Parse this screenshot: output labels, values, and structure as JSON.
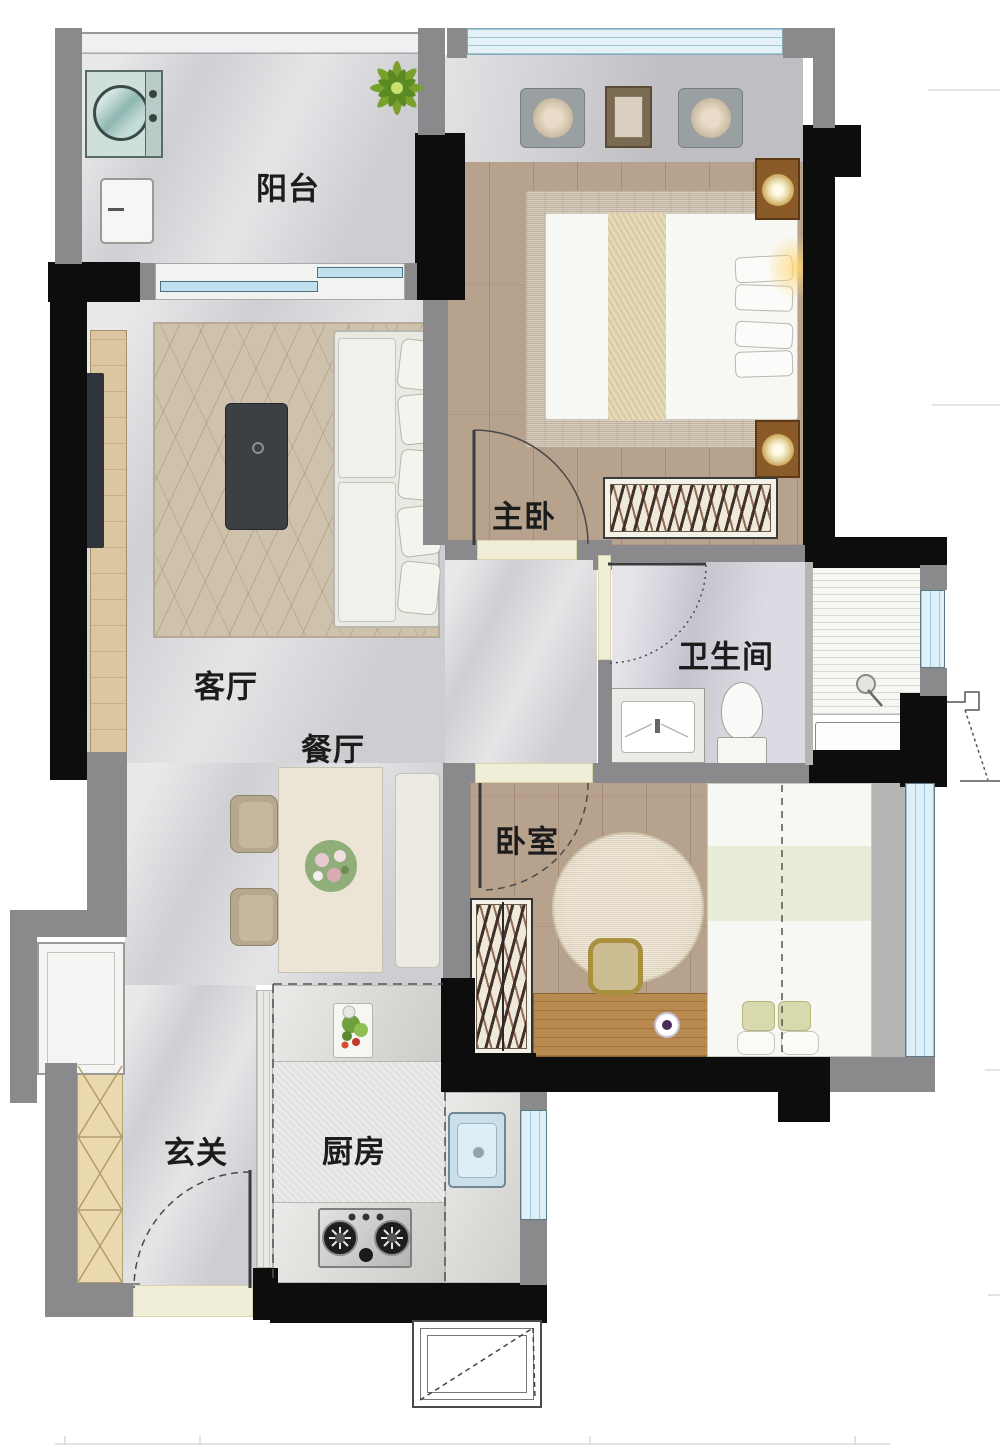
{
  "rooms": {
    "balcony": {
      "label": "阳台"
    },
    "master_bedroom": {
      "label": "主卧"
    },
    "living_room": {
      "label": "客厅"
    },
    "dining_room": {
      "label": "餐厅"
    },
    "bathroom": {
      "label": "卫生间"
    },
    "bedroom": {
      "label": "卧室"
    },
    "kitchen": {
      "label": "厨房"
    },
    "entry": {
      "label": "玄关"
    }
  },
  "colors": {
    "wall_black": "#0d0d0d",
    "wall_gray": "#8a8a8c",
    "window_blue": "#bfe0ec",
    "wood_floor": "#b7a28e",
    "marble_floor": "#d7d6da",
    "label_text": "#1c1c1c"
  }
}
